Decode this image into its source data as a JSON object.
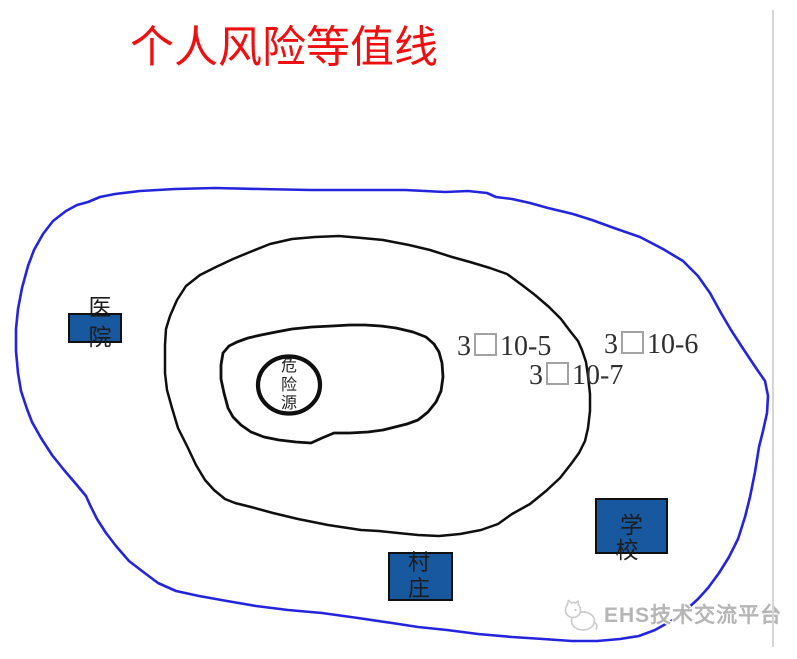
{
  "title": {
    "text": "个人风险等值线"
  },
  "risk_labels": [
    {
      "before_box": "3",
      "after_box": "10-5"
    },
    {
      "before_box": "3",
      "after_box": "10-6"
    },
    {
      "before_box": "3",
      "after_box": "10-7"
    }
  ],
  "sites": {
    "hospital": {
      "label": "医院"
    },
    "school": {
      "label": "学校"
    },
    "village": {
      "label": "村庄"
    }
  },
  "hazard_source": {
    "label": "危险源"
  },
  "watermark": {
    "brand": "EHS技术交流平台"
  },
  "colors": {
    "title_red": "#ee1010",
    "outer_contour_blue": "#2424dd",
    "contour_black": "#0f0f0f",
    "site_rect_fill": "#17589e",
    "site_rect_border": "#101010",
    "risk_label_text": "#2f2f2f",
    "missing_glyph_box_border": "#a3a3a3",
    "watermark_gray": "#b5b5b5",
    "divider_gray": "#d6d6d6"
  }
}
